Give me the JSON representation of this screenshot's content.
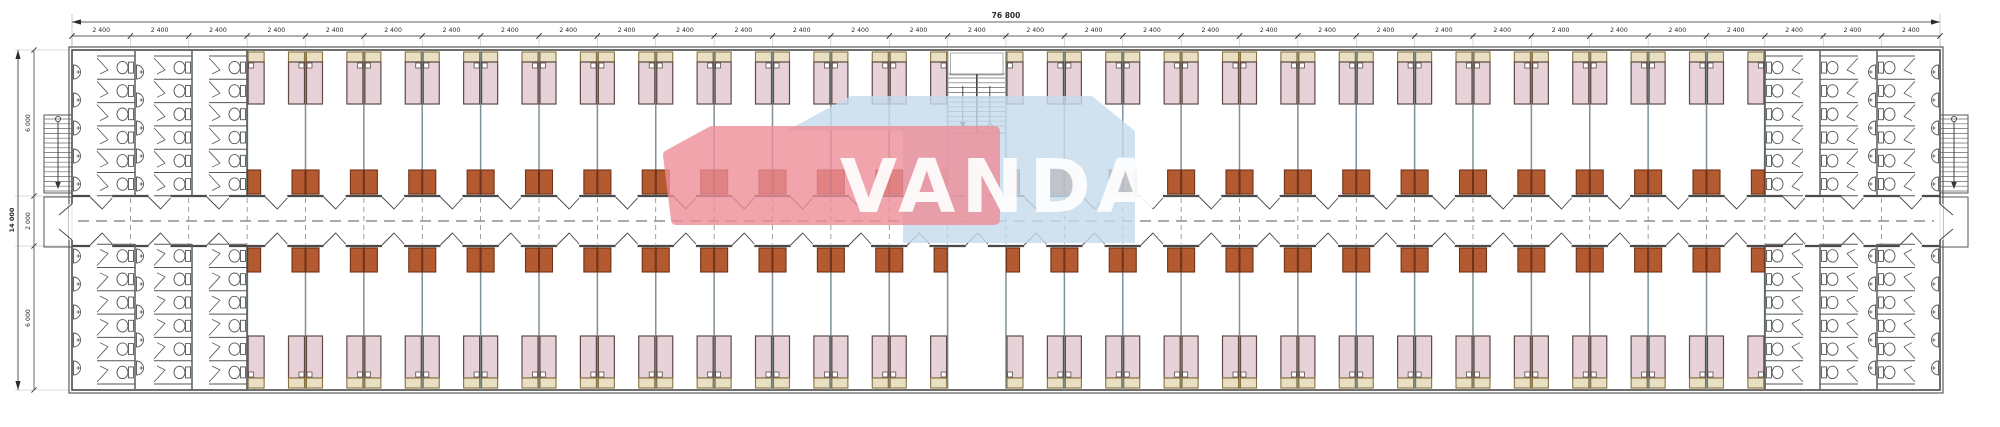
{
  "drawing": {
    "kind": "dormitory-floor-plan",
    "watermark": {
      "text": "VANDA",
      "red": "#ee8e98",
      "blue": "#c6daed",
      "text_color": "#ffffff"
    },
    "dimensions": {
      "top_total": "76 800",
      "left_total": "14 000",
      "left_segments": [
        "6 000",
        "2 000",
        "6 000"
      ],
      "top_bay_labels": [
        "2 400",
        "2 400",
        "2 400",
        "2 400",
        "2 400",
        "2 400",
        "2 400",
        "2 400",
        "2 400",
        "2 400",
        "2 400",
        "2 400",
        "2 400",
        "2 400",
        "2 400",
        "2 400",
        "2 400",
        "2 400",
        "2 400",
        "2 400",
        "2 400",
        "2 400",
        "2 400",
        "2 400",
        "2 400",
        "2 400",
        "2 400",
        "2 400",
        "2 400",
        "2 400",
        "2 400",
        "2 400"
      ]
    },
    "colors": {
      "paper": "#ffffff",
      "wall": "#4a4a4a",
      "partition": "#7e909a",
      "bed_fill": "#e6d2d8",
      "bed_stroke": "#5f4b44",
      "headboard_fill": "#e9e0c4",
      "headboard_stroke": "#8a7440",
      "wardrobe_fill": "#b45a31",
      "wardrobe_stroke": "#703318",
      "fixture": "#555555",
      "dim": "#2a2a2a",
      "dash": "#555555"
    },
    "symbols": {
      "bed": "bed-symbol",
      "wardrobe": "wardrobe-symbol",
      "toilet": "toilet-symbol",
      "washbasin": "washbasin-symbol",
      "stair": "stair-symbol",
      "door": "door-swing-symbol"
    }
  }
}
